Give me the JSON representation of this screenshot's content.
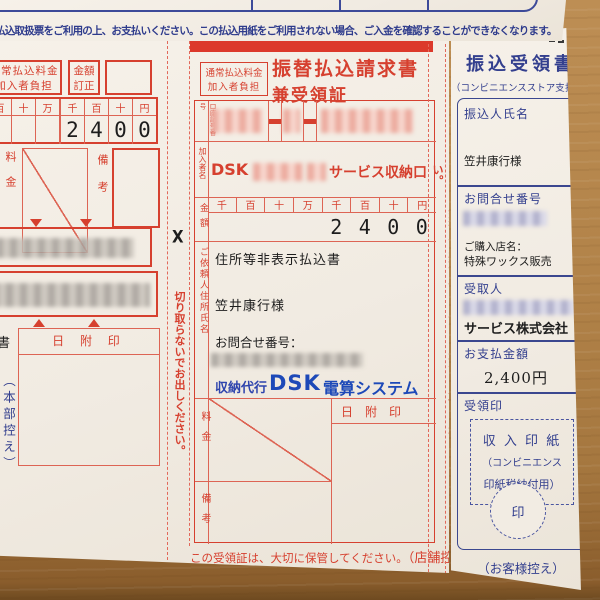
{
  "colors": {
    "form_red": "#d6402f",
    "line_red": "#dd6454",
    "navy_blue": "#333f8e",
    "logo_blue": "#1d49b8",
    "paper": "#f2ece3",
    "wood": "#a87c42"
  },
  "notice_top": "払込取扱票をご利用の上、お支払いください。この払込用紙をご利用されない場合、ご入金を確認することができなくなります。",
  "left_form": {
    "fee_line1": "通常払込料金",
    "fee_line2": "加入者負担",
    "correction_line1": "金額",
    "correction_line2": "訂正",
    "digit_headers": [
      "百",
      "十",
      "万",
      "千",
      "百",
      "十",
      "円"
    ],
    "amount_digits": [
      "2",
      "4",
      "0",
      "0"
    ],
    "fee_label": "料金",
    "remarks_label": "備考",
    "partial_char": "書",
    "date_stamp_label": "日 附 印",
    "copy_label": "（本部控え）"
  },
  "cut_strip": {
    "x_mark": "X",
    "text": "切り取らないでお出しください。"
  },
  "middle_form": {
    "fee_line1": "通常払込料金",
    "fee_line2": "加入者負担",
    "title_line1": "振替払込請求書",
    "title_line2": "兼受領証",
    "account_label": "口座記号番号",
    "payee_label": "加入者名",
    "payee_prefix": "DSK",
    "payee_suffix": "サービス収納口",
    "amount_label": "金額",
    "digit_headers": [
      "千",
      "百",
      "十",
      "万",
      "千",
      "百",
      "十",
      "円"
    ],
    "amount_digits": [
      "2",
      "4",
      "0",
      "0"
    ],
    "client_label": "ご依頼人住所氏名",
    "note": "住所等非表示払込書",
    "client_name": "笠井康行様",
    "inquiry_label": "お問合せ番号：",
    "agency_prefix": "収納代行",
    "agency_logo": "DSK",
    "agency_suffix": "電算システム",
    "fee_label": "料金",
    "date_stamp_label": "日　附　印",
    "remarks_label": "備考",
    "footer": "この受領証は、大切に保管してください。",
    "footer_copy": "（店舗控え）"
  },
  "right_strip": "ゆうちょ銀行又は郵便局でお支払いの場合は左側の2枚だけをお出しください。",
  "right_receipt": {
    "title": "振込受領書",
    "subtitle": "（コンビニエンスストア支払用）",
    "payer_label": "振込人氏名",
    "payer_name": "笠井康行様",
    "inquiry_label": "お問合せ番号",
    "store_label": "ご購入店名：",
    "store_name": "特殊ワックス販売",
    "recipient_label": "受取人",
    "recipient_name": "サービス株式会社",
    "amount_label": "お支払金額",
    "amount_value": "2,400円",
    "stamp_label": "受領印",
    "revenue_line1": "収 入 印 紙",
    "revenue_line2": "（コンビニエンス",
    "revenue_line3": "印紙税納付用）",
    "seal": "印",
    "copy_label": "（お客様控え）"
  }
}
